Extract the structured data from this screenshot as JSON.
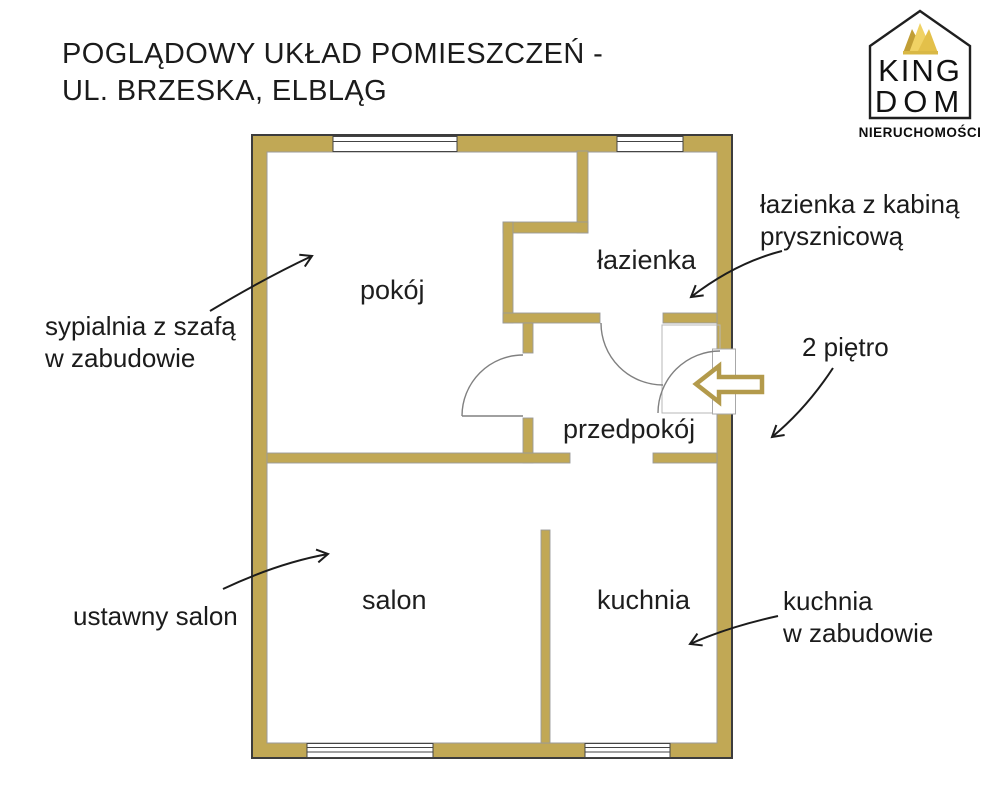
{
  "title": {
    "line1": "POGLĄDOWY UKŁAD POMIESZCZEŃ -",
    "line2": "UL. BRZESKA, ELBLĄG"
  },
  "logo": {
    "brand_top": "KING",
    "brand_bottom": "DOM",
    "subtitle": "NIERUCHOMOŚCI",
    "crown_icon": "crown-icon",
    "house_icon": "house-outline-icon"
  },
  "rooms": {
    "pokoj": "pokój",
    "lazienka": "łazienka",
    "przedpokoj": "przedpokój",
    "salon": "salon",
    "kuchnia": "kuchnia"
  },
  "annotations": {
    "bedroom": {
      "line1": "sypialnia z szafą",
      "line2": "w zabudowie"
    },
    "bathroom": {
      "line1": "łazienka z kabiną",
      "line2": "prysznicową"
    },
    "floor": "2 piętro",
    "living": "ustawny salon",
    "kitchen": {
      "line1": "kuchnia",
      "line2": "w zabudowie"
    }
  },
  "colors": {
    "wall_gold": "#C1A855",
    "entrance_arrow_gold": "#B39A4B",
    "outer_outline": "#3c3c3c",
    "inner_outline": "#9a9a9a",
    "door_arc_gray": "#808080",
    "annotation_black": "#1c1c1c",
    "crown_light": "#F0D264",
    "crown_mid": "#E3C04A",
    "crown_dark": "#C19E35"
  }
}
